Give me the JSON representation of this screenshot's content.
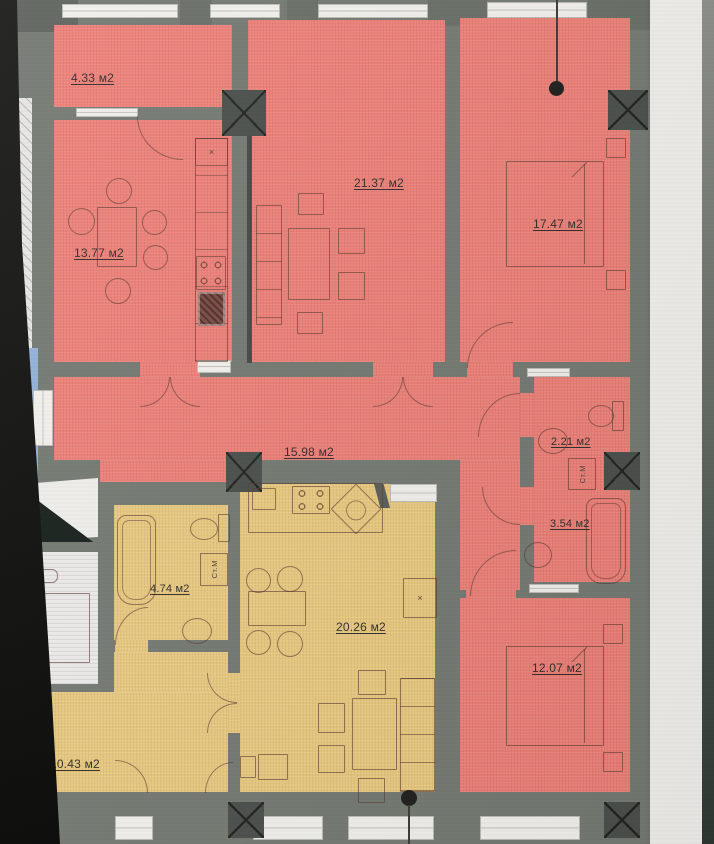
{
  "colors": {
    "apartment_pink": "#ee8078",
    "apartment_yellow": "#eaca80",
    "wall": "#757a73",
    "wall_dark": "#6a6f68",
    "column": "#4b504c",
    "window": "#f2f1ed",
    "adjacent_blue": "#93b2d8",
    "adjacent_white": "#edecea",
    "background": "#d7d6d2"
  },
  "units": "м2",
  "rooms": [
    {
      "id": "balcony",
      "apartment": "pink",
      "area_label": "4.33 м2"
    },
    {
      "id": "kitchen-dining",
      "apartment": "pink",
      "area_label": "13.77 м2"
    },
    {
      "id": "living-room",
      "apartment": "pink",
      "area_label": "21.37 м2"
    },
    {
      "id": "bedroom-1",
      "apartment": "pink",
      "area_label": "17.47 м2"
    },
    {
      "id": "hall",
      "apartment": "pink",
      "area_label": "15.98 м2"
    },
    {
      "id": "wc",
      "apartment": "pink",
      "area_label": "2.21 м2"
    },
    {
      "id": "bathroom-1",
      "apartment": "pink",
      "area_label": "3.54 м2"
    },
    {
      "id": "bedroom-2",
      "apartment": "pink",
      "area_label": "12.07 м2"
    },
    {
      "id": "bathroom-2",
      "apartment": "yellow",
      "area_label": "4.74 м2"
    },
    {
      "id": "kitchen-living",
      "apartment": "yellow",
      "area_label": "20.26 м2"
    },
    {
      "id": "hallway",
      "apartment": "yellow",
      "area_label": "10.43 м2"
    },
    {
      "id": "neighbor-room",
      "apartment": "adjacent",
      "area_label": "7 м2"
    }
  ],
  "fixtures": {
    "washer_label_1": "Ст.М",
    "washer_label_2": "Ст.М",
    "x_mark_1": "×",
    "x_mark_2": "×"
  }
}
